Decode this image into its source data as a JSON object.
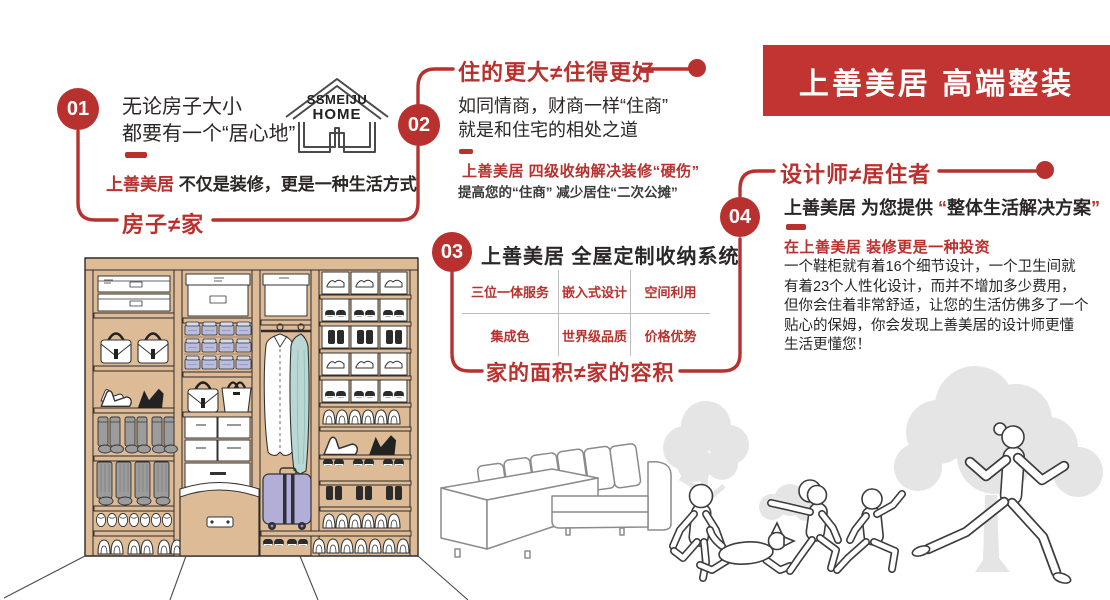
{
  "colors": {
    "brand_red": "#b8312e",
    "banner_red": "#c23432",
    "text_dark": "#2b2726",
    "wardrobe_tan": "#debb97",
    "bin_lavender": "#b9bedd",
    "suitcase_lavender": "#b3aed6",
    "garment_teal": "#b9d8d4",
    "boot_gray": "#9c9c9c",
    "tree_gray": "#e5e5e5"
  },
  "banner": {
    "title": "上善美居 高端整装"
  },
  "logo": {
    "line1": "SSMEIJU",
    "line2": "HOME"
  },
  "steps": {
    "s1": {
      "number": "01",
      "intro_line1": "无论房子大小",
      "intro_line2": "都要有一个“居心地”",
      "tagline_brand": "上善美居",
      "tagline_rest": "不仅是装修，更是一种生活方式",
      "headline": "房子≠家"
    },
    "s2": {
      "number": "02",
      "headline": "住的更大≠住得更好",
      "body_line1": "如同情商，财商一样“住商”",
      "body_line2": "就是和住宅的相处之道",
      "note_red": "上善美居 四级收纳解决装修“硬伤”",
      "note_sub": "提高您的“住商” 减少居住“二次公摊”"
    },
    "s3": {
      "number": "03",
      "title": "上善美居 全屋定制收纳系统",
      "features": [
        [
          "三位一体服务",
          "嵌入式设计",
          "空间利用"
        ],
        [
          "集成色",
          "世界级品质",
          "价格优势"
        ]
      ],
      "headline": "家的面积≠家的容积"
    },
    "s4": {
      "number": "04",
      "headline": "设计师≠居住者",
      "promise_brand": "上善美居",
      "promise_mid": " 为您提供 ",
      "promise_open": "“",
      "promise_text": "整体生活解决方案",
      "promise_close": "”",
      "note_red": "在上善美居 装修更是一种投资",
      "paragraph": [
        "一个鞋柜就有着16个细节设计，一个卫生间就",
        "有着23个人性化设计，而并不增加多少费用，",
        "但你会住着非常舒适，让您的生活仿佛多了一个",
        "贴心的保姆，你会发现上善美居的设计师更懂",
        "生活更懂您！"
      ]
    }
  }
}
